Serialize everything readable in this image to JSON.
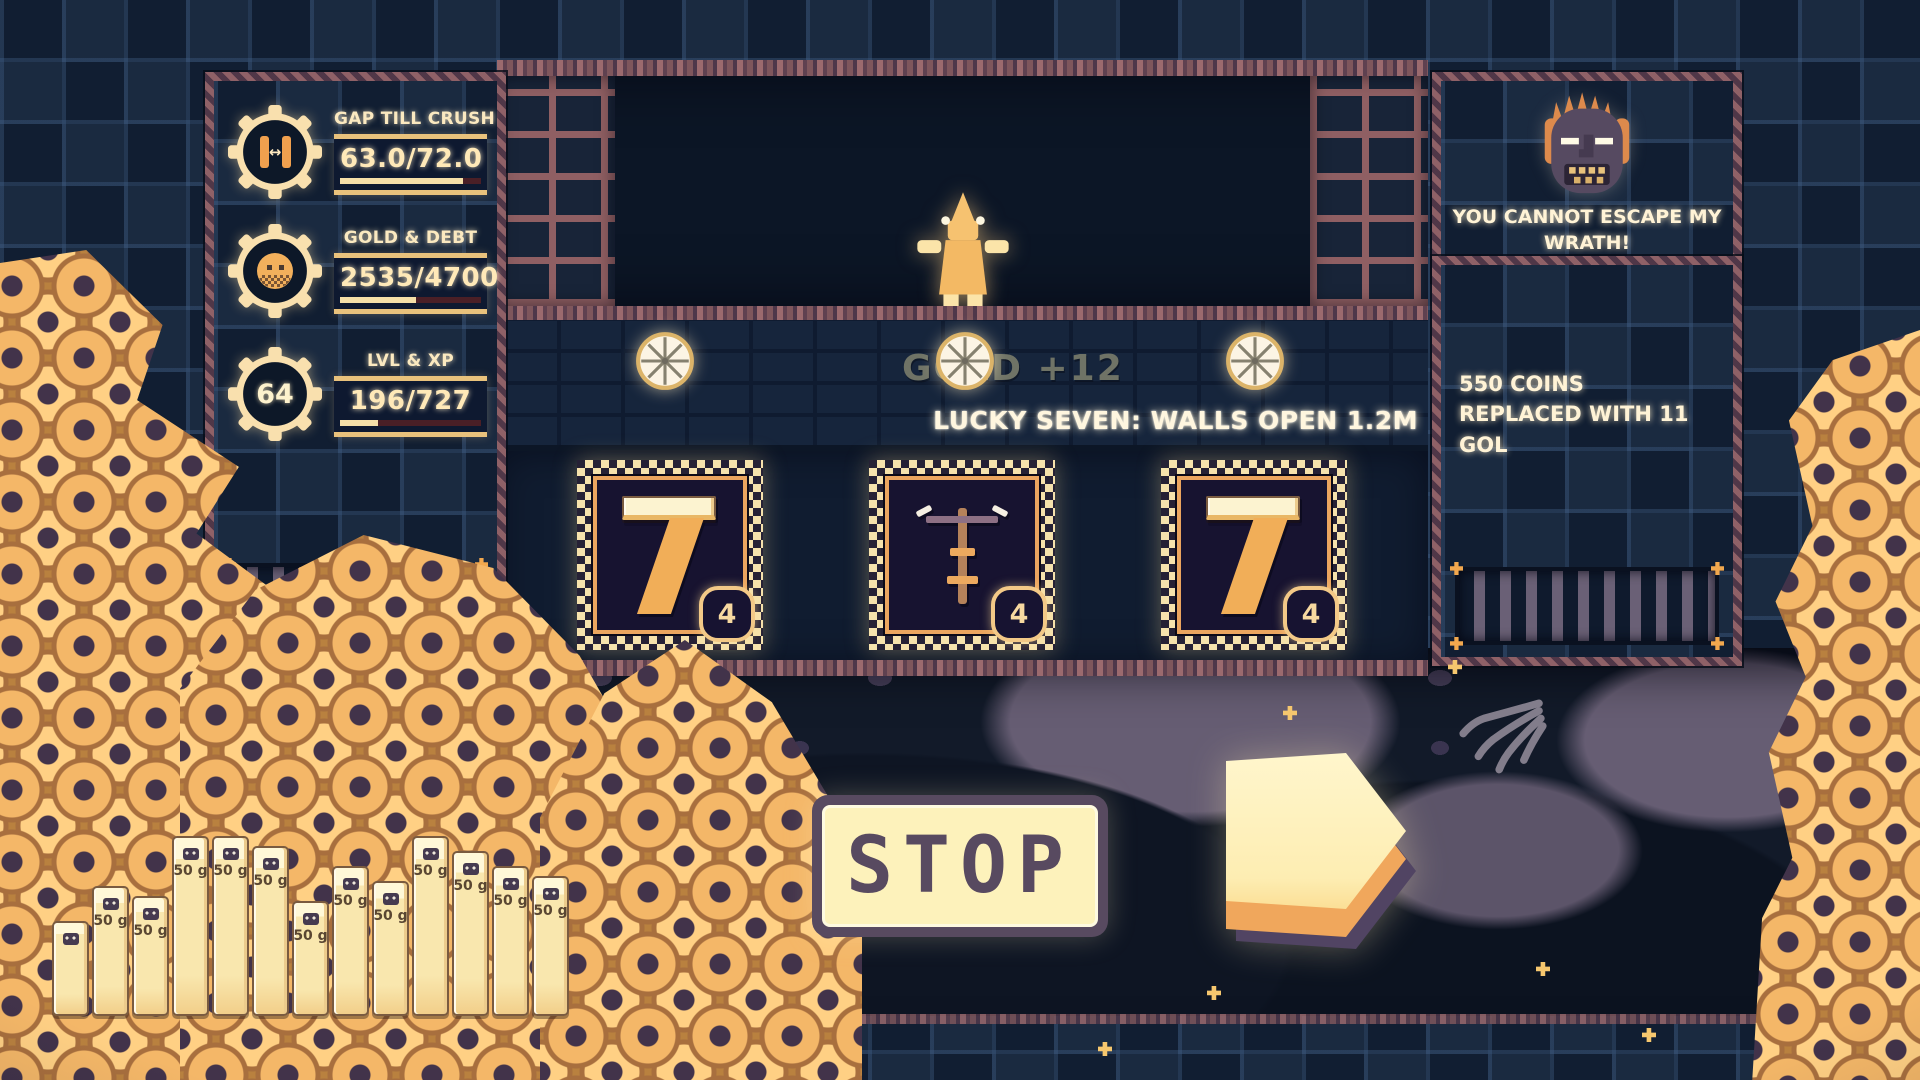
{
  "left_panel": {
    "stats": [
      {
        "label": "GAP TILL CRUSH",
        "value": "63.0/72.0",
        "progress": 0.875,
        "icon": "gap-gauge-icon"
      },
      {
        "label": "GOLD & DEBT",
        "value": "2535/4700",
        "progress": 0.54,
        "icon": "debt-coin-icon"
      },
      {
        "label": "LVL & XP",
        "value": "196/727",
        "progress": 0.27,
        "level": "64",
        "icon": "level-badge-icon"
      }
    ]
  },
  "machine": {
    "gold_popup": "GOLD +12",
    "event_text": "LUCKY SEVEN: WALLS OPEN 1.2M",
    "reels": [
      {
        "symbol": "seven",
        "count": "4"
      },
      {
        "symbol": "crossbow",
        "count": "4"
      },
      {
        "symbol": "seven",
        "count": "4"
      }
    ]
  },
  "right_panel": {
    "wrath_message": "YOU CANNOT ESCAPE MY WRATH!",
    "info_message": "550 COINS REPLACED WITH 11 GOL"
  },
  "controls": {
    "stop_label": "STOP"
  },
  "gold_bars": {
    "unit_label": "50 g",
    "bars": [
      95,
      130,
      120,
      180,
      180,
      170,
      115,
      150,
      135,
      180,
      165,
      150,
      140
    ]
  },
  "icons": {
    "gap-gauge-icon": "gear ring with piston gap arrows",
    "debt-coin-icon": "gear ring with gold coin",
    "level-badge-icon": "gear ring with level number",
    "wheel-ornament-icon": "white spoked wheel",
    "slot-symbol-seven": "golden lucky seven",
    "slot-symbol-crossbow": "golden crossbow rod",
    "wrath-face-icon": "angry mask with orange hair",
    "skeleton-hand-icon": "gray skeletal hand",
    "play-lever-icon": "3d right arrow",
    "gold-bar-face-icon": "small dark face stamp"
  },
  "colors": {
    "gold": "#f2b35e",
    "cream": "#fdf2bb",
    "glow_text": "#fff6df",
    "panel_trim": "#8f6167",
    "background": "#142338",
    "cave": "#121a29",
    "popup_gray": "#6f7366"
  }
}
